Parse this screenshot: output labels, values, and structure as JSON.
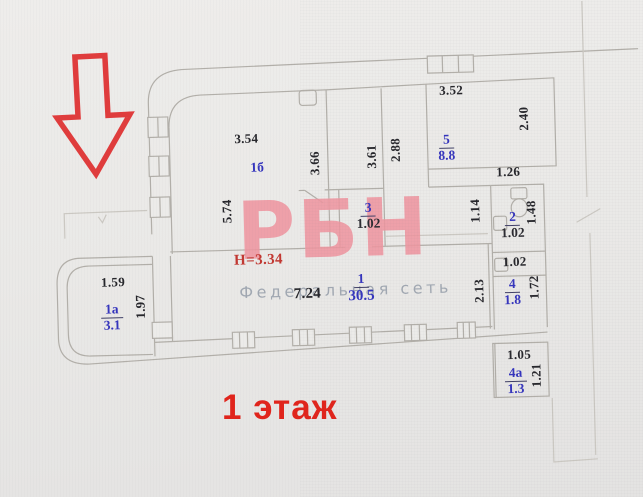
{
  "floor_plan": {
    "floor_label": "1 этаж",
    "height_note": "Н=3.34",
    "watermark": {
      "logo": "РБН",
      "tagline": "Федеральная сеть"
    },
    "arrow": "red-outlined-down-arrow",
    "colors": {
      "wall_line": "#b2afa9",
      "dimension_text": "#26262b",
      "room_text_blue": "#3434bd",
      "note_red": "#c23832",
      "floor_label_red": "#e1241b",
      "watermark_pink": "#ef96a0",
      "arrow_red": "#e03c3c",
      "background": "#eae9e7"
    },
    "rooms": [
      {
        "number": "1а",
        "value": "3.1",
        "value_color": "blue",
        "x": 110,
        "y": 295
      },
      {
        "number": "1б",
        "value": "",
        "value_color": "",
        "x": 259,
        "y": 157
      },
      {
        "number": "1",
        "value": "30.5",
        "value_color": "blue",
        "x": 360,
        "y": 271,
        "big": true
      },
      {
        "number": "2",
        "value": "1.02",
        "value_color": "black",
        "x": 513,
        "y": 213
      },
      {
        "number": "3",
        "value": "1.02",
        "value_color": "black",
        "x": 369,
        "y": 200
      },
      {
        "number": "4",
        "value": "1.8",
        "value_color": "blue",
        "x": 511,
        "y": 280
      },
      {
        "number": "4а",
        "value": "1.3",
        "value_color": "blue",
        "x": 512,
        "y": 369
      },
      {
        "number": "5",
        "value": "8.8",
        "value_color": "blue",
        "x": 449,
        "y": 134
      }
    ],
    "dimensions": [
      {
        "text": "3.54",
        "x": 249,
        "y": 137,
        "rot": 0
      },
      {
        "text": "3.52",
        "x": 455,
        "y": 94,
        "rot": 0
      },
      {
        "text": "3.66",
        "x": 317,
        "y": 163,
        "rot": 90
      },
      {
        "text": "3.61",
        "x": 374,
        "y": 158,
        "rot": 90
      },
      {
        "text": "2.88",
        "x": 398,
        "y": 152,
        "rot": 90
      },
      {
        "text": "2.40",
        "x": 527,
        "y": 124,
        "rot": 90
      },
      {
        "text": "5.74",
        "x": 228,
        "y": 209,
        "rot": 90
      },
      {
        "text": "1.26",
        "x": 510,
        "y": 177,
        "rot": 0
      },
      {
        "text": "1.14",
        "x": 476,
        "y": 215,
        "rot": 90
      },
      {
        "text": "1.48",
        "x": 532,
        "y": 218,
        "rot": 90
      },
      {
        "text": "1.02",
        "x": 514,
        "y": 267,
        "rot": 0
      },
      {
        "text": "1.72",
        "x": 533,
        "y": 293,
        "rot": 90
      },
      {
        "text": "2.13",
        "x": 478,
        "y": 295,
        "rot": 90
      },
      {
        "text": "7.24",
        "x": 306,
        "y": 294,
        "rot": 0,
        "big": true
      },
      {
        "text": "1.59",
        "x": 112,
        "y": 277,
        "rot": 0
      },
      {
        "text": "1.97",
        "x": 139,
        "y": 302,
        "rot": 90
      },
      {
        "text": "1.05",
        "x": 516,
        "y": 360,
        "rot": 0
      },
      {
        "text": "1.21",
        "x": 533,
        "y": 381,
        "rot": 90
      }
    ]
  }
}
